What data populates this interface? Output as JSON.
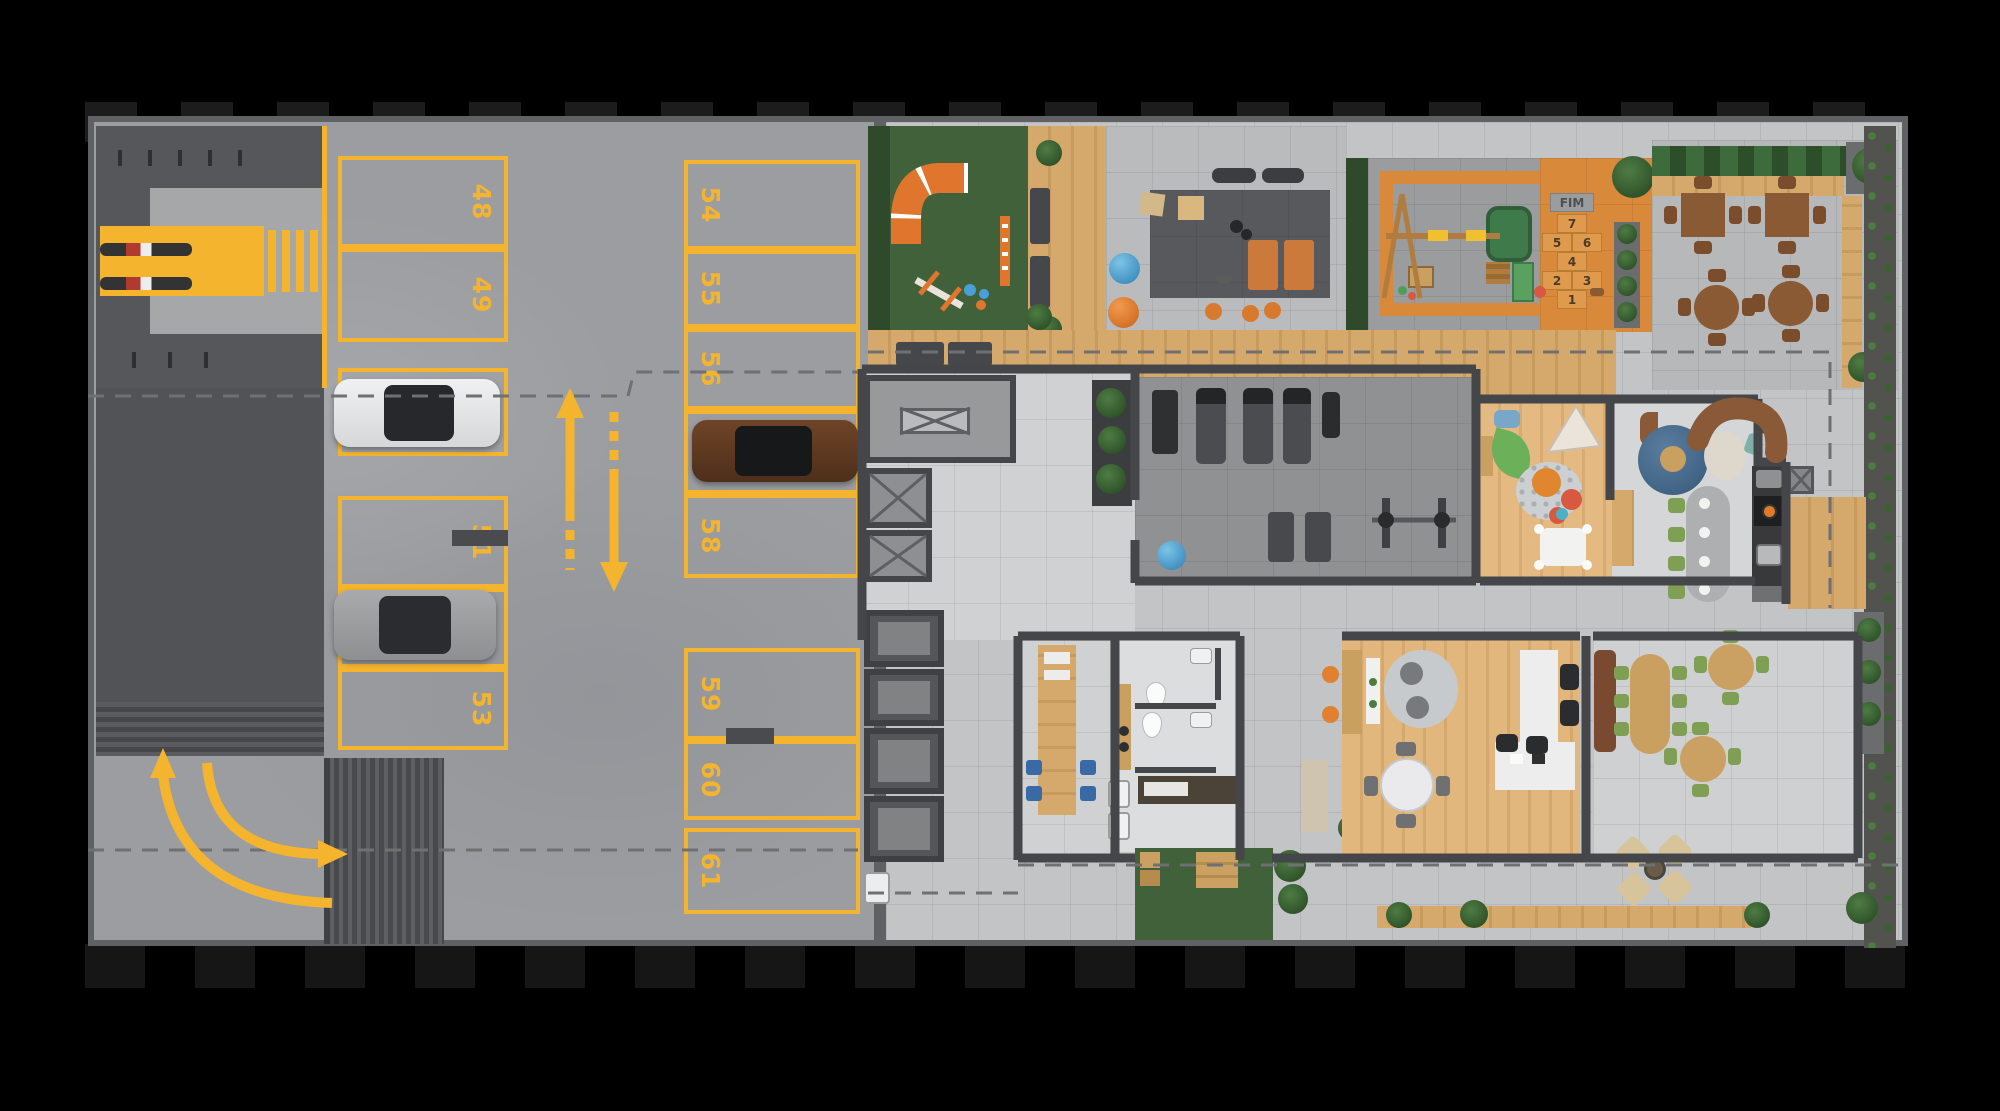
{
  "parking": {
    "space_labels": [
      "48",
      "49",
      "54",
      "55",
      "56",
      "51",
      "58",
      "53",
      "59",
      "60",
      "61"
    ],
    "marking_color": "#F5B42E"
  },
  "hopscotch": {
    "finish_label": "FIM",
    "cells": [
      "7",
      "5",
      "6",
      "4",
      "2",
      "3",
      "1"
    ]
  },
  "colors": {
    "floor_marking_yellow": "#F5B42E",
    "parking_concrete": "#9B9DA0",
    "amenity_concrete": "#C2C4C5",
    "turf_green": "#40613A",
    "deck_wood": "#D3A76B",
    "play_orange": "#DD8A3C",
    "accent_blue": "#4A9FD8",
    "wall_dark": "#46474A"
  }
}
